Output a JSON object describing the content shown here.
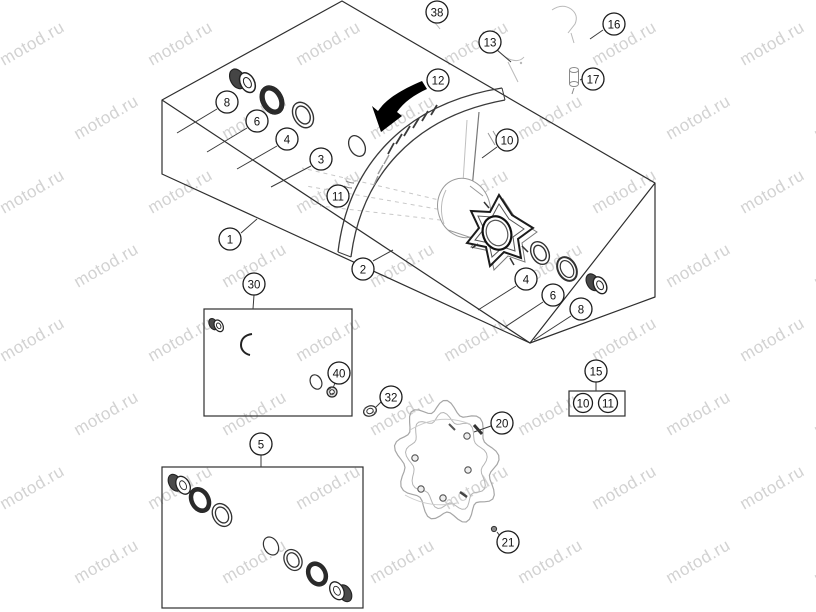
{
  "watermark": {
    "text": "motod.ru",
    "color": "#d2d2d2"
  },
  "colors": {
    "line": "#2e2e2e",
    "leader": "#3a3a3a",
    "faint": "#b9b9b9",
    "arrow": "#000000",
    "paper": "#ffffff"
  },
  "callouts": [
    {
      "label": "38",
      "x": 437,
      "y": 12
    },
    {
      "label": "13",
      "x": 490,
      "y": 42,
      "leader": [
        497,
        50,
        511,
        62
      ]
    },
    {
      "label": "16",
      "x": 614,
      "y": 24,
      "leader": [
        603,
        30,
        590,
        39
      ]
    },
    {
      "label": "17",
      "x": 593,
      "y": 79,
      "leader": [
        582,
        79,
        580,
        80
      ]
    },
    {
      "label": "12",
      "x": 438,
      "y": 80
    },
    {
      "label": "10",
      "x": 507,
      "y": 140,
      "leader": [
        497,
        147,
        482,
        158
      ]
    },
    {
      "label": "8",
      "x": 227,
      "y": 102,
      "leader": [
        217,
        109,
        177,
        133
      ]
    },
    {
      "label": "6",
      "x": 257,
      "y": 121,
      "leader": [
        247,
        128,
        207,
        152
      ]
    },
    {
      "label": "4",
      "x": 287,
      "y": 139,
      "leader": [
        277,
        146,
        237,
        169
      ]
    },
    {
      "label": "3",
      "x": 321,
      "y": 159,
      "leader": [
        311,
        166,
        271,
        187
      ]
    },
    {
      "label": "11",
      "x": 338,
      "y": 196
    },
    {
      "label": "1",
      "x": 230,
      "y": 239,
      "leader": [
        241,
        233,
        257,
        219
      ]
    },
    {
      "label": "2",
      "x": 363,
      "y": 269,
      "leader": [
        373,
        261,
        393,
        250
      ]
    },
    {
      "label": "30",
      "x": 254,
      "y": 284,
      "leader": [
        254,
        295,
        253,
        309
      ]
    },
    {
      "label": "4",
      "x": 526,
      "y": 279,
      "leader": [
        516,
        286,
        478,
        310
      ]
    },
    {
      "label": "6",
      "x": 553,
      "y": 295,
      "leader": [
        543,
        302,
        505,
        327
      ]
    },
    {
      "label": "8",
      "x": 581,
      "y": 309,
      "leader": [
        571,
        316,
        534,
        340
      ]
    },
    {
      "label": "15",
      "x": 596,
      "y": 371,
      "leader": [
        596,
        382,
        596,
        391
      ]
    },
    {
      "label": "10",
      "x": 583,
      "y": 403,
      "r": 9.5
    },
    {
      "label": "11",
      "x": 608,
      "y": 403,
      "r": 9.5
    },
    {
      "label": "40",
      "x": 339,
      "y": 373,
      "leader": [
        335,
        383,
        333,
        388
      ]
    },
    {
      "label": "32",
      "x": 391,
      "y": 397,
      "leader": [
        382,
        401,
        376,
        407
      ]
    },
    {
      "label": "20",
      "x": 502,
      "y": 423,
      "leader": [
        491,
        426,
        474,
        432
      ]
    },
    {
      "label": "21",
      "x": 508,
      "y": 542,
      "leader": [
        500,
        536,
        497,
        532
      ]
    },
    {
      "label": "5",
      "x": 261,
      "y": 444,
      "leader": [
        261,
        455,
        261,
        467
      ]
    }
  ],
  "group_boxes": [
    {
      "name": "kit-box-30",
      "x": 204,
      "y": 309,
      "w": 148,
      "h": 107
    },
    {
      "name": "kit-box-5",
      "x": 162,
      "y": 467,
      "w": 201,
      "h": 141
    },
    {
      "name": "ref-box-15",
      "x": 569,
      "y": 391,
      "w": 56,
      "h": 25
    }
  ]
}
